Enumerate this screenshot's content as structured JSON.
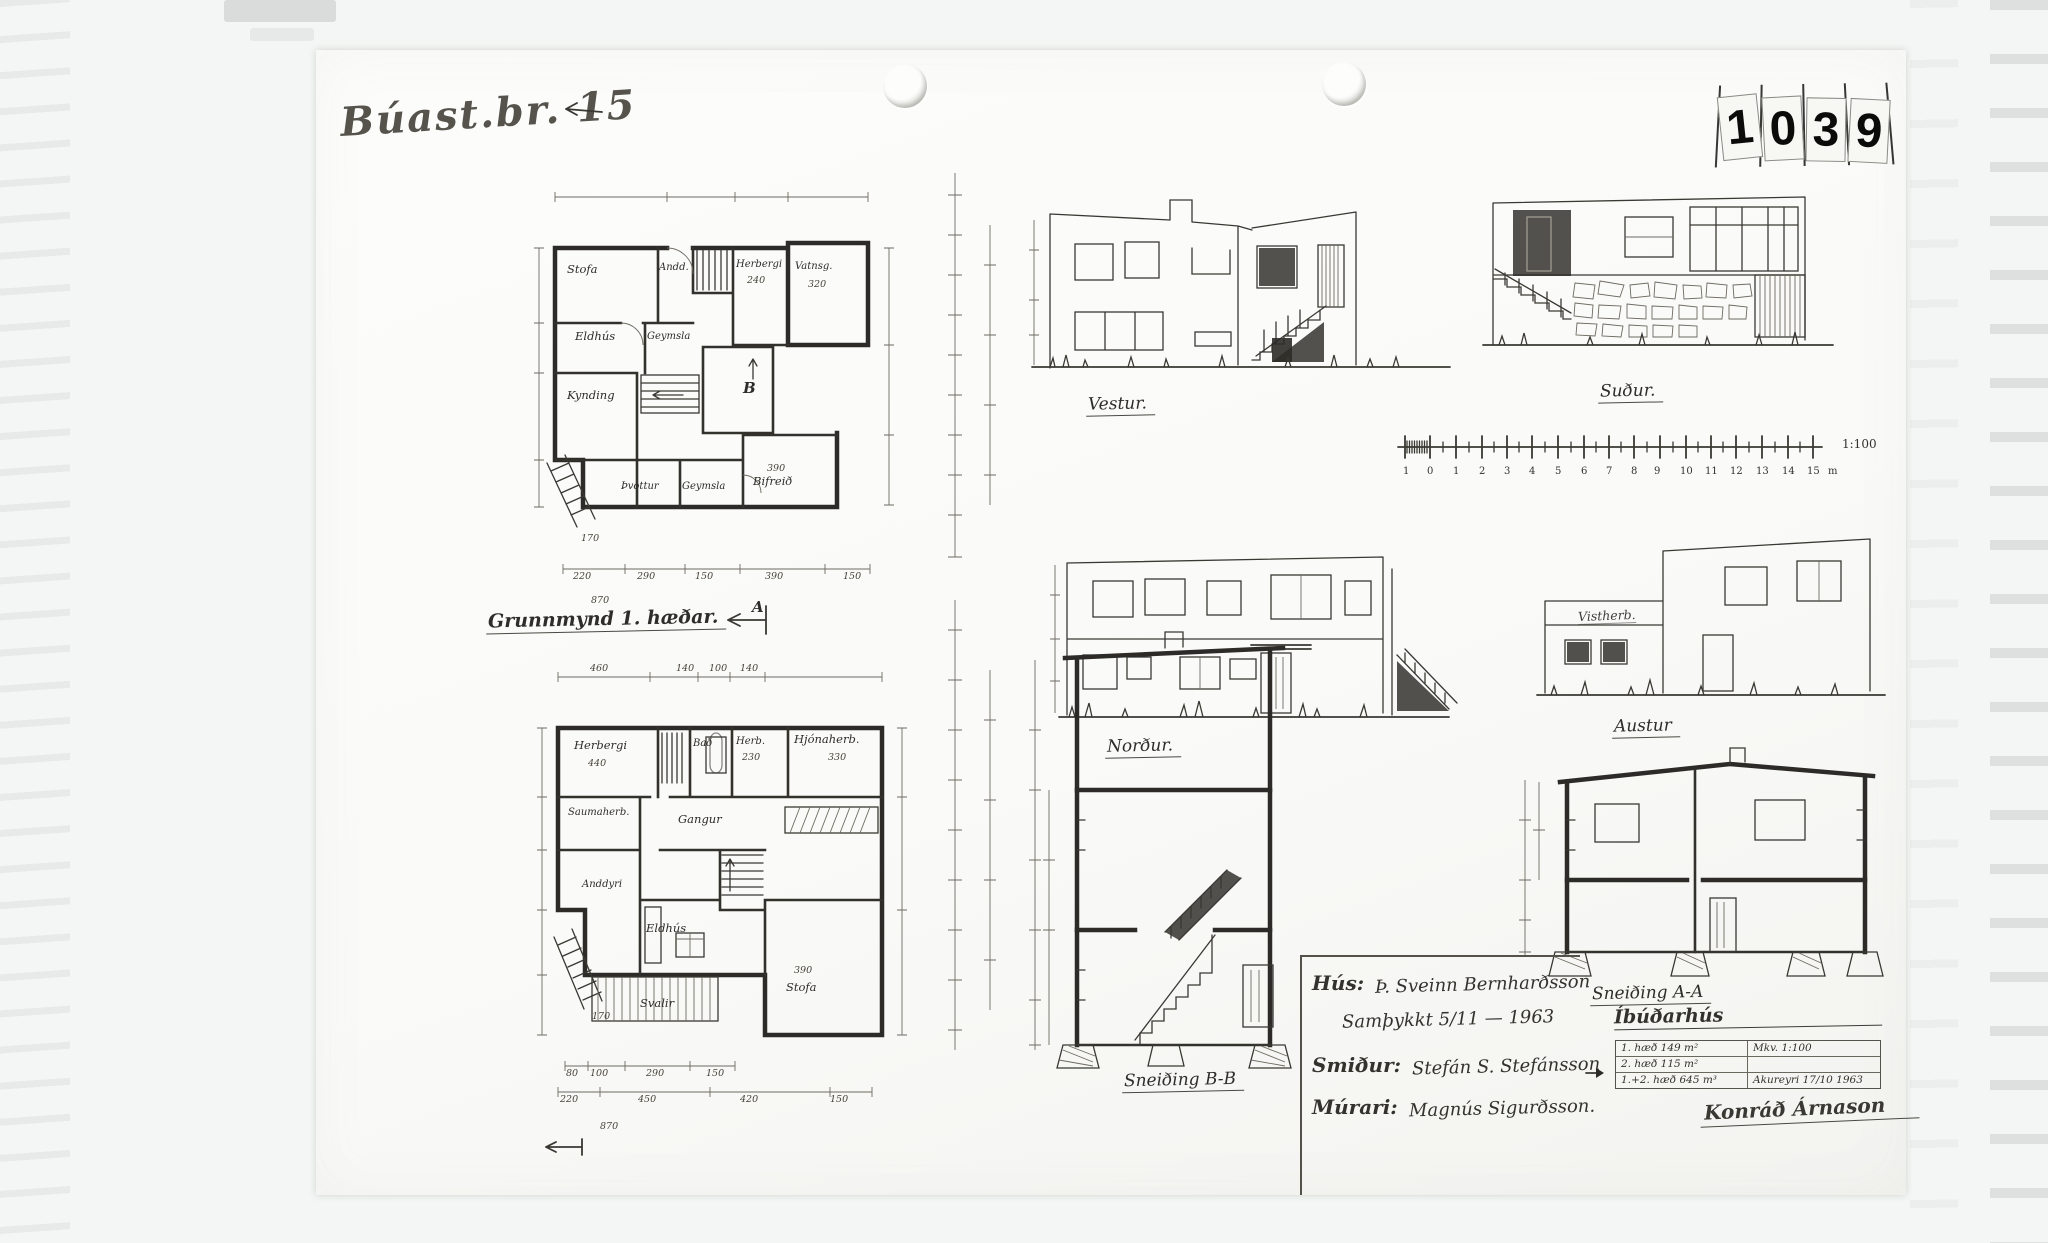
{
  "document": {
    "ref_handwritten": "Búast.br. 15",
    "stamp_digits": [
      "1",
      "0",
      "3",
      "9"
    ]
  },
  "plans": {
    "basement": {
      "rooms": {
        "stofa": "Stofa",
        "andd": "Andd.",
        "herbergi": "Herbergi",
        "herbergi_area": "240",
        "vatnsg": "Vatnsg.",
        "vatnsg_area": "320",
        "eldhus": "Eldhús",
        "geymsla": "Geymsla",
        "kynding": "Kynding",
        "thvottur": "Þvottur",
        "geymsla2": "Geymsla",
        "bifreid": "Bifreið",
        "bifreid_area": "390",
        "section_marker": "B"
      },
      "dims_bottom": [
        "220",
        "290",
        "150",
        "390",
        "150"
      ],
      "dim_total": "870",
      "dim_stair": "170"
    },
    "first_floor": {
      "title": "Grunnmynd 1. hæðar.",
      "section_marker": "A",
      "rooms": {
        "herbergi": "Herbergi",
        "herbergi_area": "440",
        "bad": "Bað",
        "herb": "Herb.",
        "herb_area": "230",
        "hjonaherb": "Hjónaherb.",
        "hjonaherb_area": "330",
        "saumaherb": "Saumaherb.",
        "gangur": "Gangur",
        "anddyri": "Anddyri",
        "eldhus": "Eldhús",
        "svalir": "Svalir",
        "stofa": "Stofa",
        "stofa_area": "390"
      },
      "dims_top": [
        "460",
        "140",
        "100",
        "140"
      ],
      "dims_bottom": [
        "80",
        "100",
        "290",
        "150"
      ],
      "dims_bottom2": [
        "220",
        "450",
        "420",
        "150"
      ],
      "dim_total": "870",
      "dim_stair": "170"
    }
  },
  "elevations": {
    "vestur": "Vestur.",
    "sudur": "Suður.",
    "nordur": "Norður.",
    "austur": "Austur",
    "annotation": "Vistherb."
  },
  "sections": {
    "bb": "Sneiðing B-B",
    "aa": "Sneiðing A-A"
  },
  "scalebar": {
    "numbers": [
      "1",
      "0",
      "1",
      "2",
      "3",
      "4",
      "5",
      "6",
      "7",
      "8",
      "9",
      "10",
      "11",
      "12",
      "13",
      "14",
      "15"
    ],
    "unit": "m",
    "ratio": "1:100"
  },
  "titleblock": {
    "house_label": "Hús:",
    "house_value": "Þ. Sveinn Bernharðsson",
    "approval": "Samþykkt 5/11 — 1963",
    "carpenter_label": "Smiður:",
    "carpenter_value": "Stefán S. Stefánsson",
    "mason_label": "Múrari:",
    "mason_value": "Magnús Sigurðsson."
  },
  "infotable": {
    "heading": "Íbúðarhús",
    "rows": [
      {
        "left": "1. hæð 149 m²",
        "right": "Mkv. 1:100"
      },
      {
        "left": "2. hæð 115 m²",
        "right": ""
      },
      {
        "left": "1.+2. hæð 645 m³",
        "right": "Akureyri 17/10 1963"
      }
    ],
    "signature": "Konráð Árnason"
  }
}
